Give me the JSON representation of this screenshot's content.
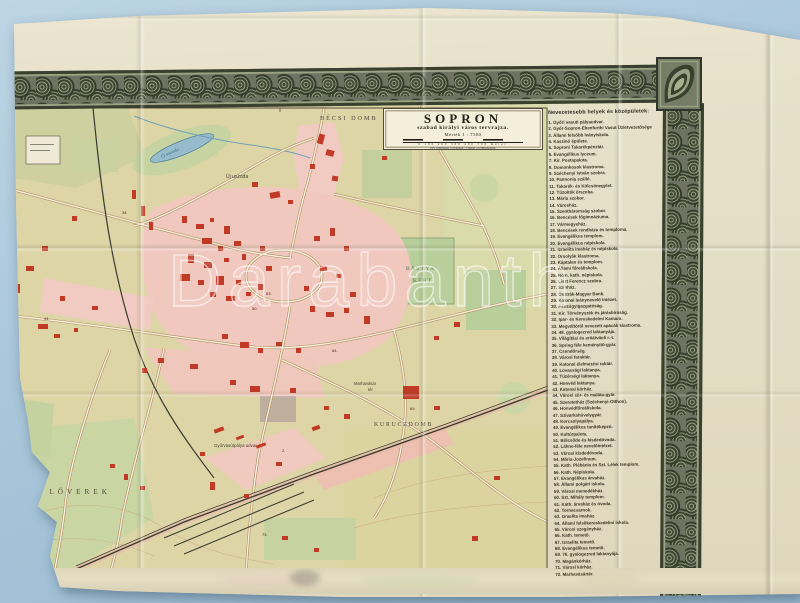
{
  "photo": {
    "background_color": "#a9c6da",
    "paper_color": "#e6e0c9",
    "ornament_color": "#4a5240"
  },
  "map_title": {
    "title": "SOPRON",
    "subtitle": "szabad királyi város tervrajza.",
    "scale": "Mérték 1 : 7500",
    "scale_ticks": "0 100 200 300 400 500",
    "scale_unit": "méter",
    "scale_note": "Egy centiméter a térképen 75 méter a természetben."
  },
  "legend": {
    "heading": "Nevezetesebb helyek és középületek:",
    "items": [
      "1. Győri vasuti pályaudvar.",
      "2. Győr-Sopron-Ebenfurthi Vasut Üzletvezetősége",
      "3. Állami felsőbb leányiskola.",
      "4. Kaszinó épülete.",
      "5. Soproni Takarékpénztár.",
      "6. Evangélikus lyceum.",
      "7. Kir. Postapalota.",
      "8. Domonkosok klastroma.",
      "9. Széchenyi István szobra.",
      "10. Pannonia szálló.",
      "11. Takarék- és Kölcsönegylet.",
      "12. Tűzoltók őrszoba.",
      "13. Mária szobor.",
      "14. Városház.",
      "15. Szentháromság szobor.",
      "16. Bencések főgimnáziuma.",
      "17. Vármegyeház.",
      "18. Bencések rendháza és temploma.",
      "19. Evangélikus templom.",
      "20. Evangélikus népiskola.",
      "21. Izraelita imaház és népiskola.",
      "22. Orsolyák klastroma.",
      "23. Káptalan és templom.",
      "24. Állami főreáliskola.",
      "25. Róm. kath. népiskola.",
      "26. Liszt Ferencz szobra.",
      "27. Színház.",
      "28. Osztrák-Magyar Bank.",
      "29. Katonai leánynevelő intézet.",
      "30. Pénzügyigazgatóság.",
      "31. Kir. Törvényszék és járásbíróság.",
      "32. Ipar- és Kereskedelmi Kamara.",
      "33. Megváltóról nevezett apácák klastroma.",
      "34. 48. gyalogezred laktanyája.",
      "35. Világítási és erőátviteli r.-t.",
      "36. Spring féle keményítő-gyár.",
      "37. Csendőrség.",
      "38. Városi faraktár.",
      "39. Katonai élelmezési raktár.",
      "40. Lovassági laktanya.",
      "41. Tüzérségi laktanya.",
      "42. Honvéd laktanya.",
      "43. Katonai kórház.",
      "44. Városi sör- és maláta-gyár.",
      "45. Szeretetház (Széchenyi-Otthon).",
      "46. Honvédfőreáliskola.",
      "47. Szivarkahüvelygyár.",
      "48. Korcsolyapálya.",
      "49. Evangélikus tanítóképző.",
      "50. Kultúrpalota.",
      "51. Bölcsőde és kisdedóvoda.",
      "52. Lähne-féle nevelőintézet.",
      "53. Városi kisdedóvoda.",
      "54. Mária-Jozefinum.",
      "55. Kath. Plébánia és Szt. Lélek templom.",
      "56. Kath. Népiskola.",
      "57. Evangélikus árvaház.",
      "58. Állami polgári iskola.",
      "59. Városi menedékház.",
      "60. Szt. Mihály templom.",
      "61. Kath. árvaház és óvoda.",
      "62. Tornacsarnok.",
      "63. Izraelita imaház.",
      "64. Állami felsőkereskedelmi iskola.",
      "65. Városi szegényház.",
      "66. Kath. temető.",
      "67. Izraelita temető.",
      "68. Evangélikus temető.",
      "69. 76. gyalogezred laktanyája.",
      "70. Magánkórház.",
      "71. Városi kórház.",
      "72. Marhavásártér."
    ]
  },
  "watermark": "Darabanth",
  "map_labels": [
    {
      "text": "BÉCSI DOMB",
      "x": 306,
      "y": 22,
      "size": 6.2,
      "ls": 2,
      "cls": "district-label"
    },
    {
      "text": "KIRÁLYHALOM",
      "x": 434,
      "y": 33,
      "size": 5.8,
      "ls": 1.5,
      "cls": "district-label"
    },
    {
      "text": "Ó uszoda",
      "x": 148,
      "y": 60,
      "size": 5,
      "rot": -24,
      "cls": "water-label"
    },
    {
      "text": "Új uszoda",
      "x": 212,
      "y": 80,
      "size": 5,
      "cls": "small-label"
    },
    {
      "text": "BÁSTYA",
      "x": 392,
      "y": 172,
      "size": 5.4,
      "ls": 1.4,
      "cls": "park-label"
    },
    {
      "text": "KERT",
      "x": 399,
      "y": 184,
      "size": 5.4,
      "ls": 1.4,
      "cls": "park-label"
    },
    {
      "text": "KURUCZDOMB",
      "x": 360,
      "y": 328,
      "size": 5.8,
      "ls": 1.8,
      "cls": "district-label"
    },
    {
      "text": "Marhavásár",
      "x": 340,
      "y": 287,
      "size": 4.2,
      "cls": "small-label"
    },
    {
      "text": "tér",
      "x": 354,
      "y": 293,
      "size": 4.2,
      "cls": "small-label"
    },
    {
      "text": "Győrvasútpálya udvar",
      "x": 200,
      "y": 349,
      "size": 4.4,
      "cls": "small-label"
    },
    {
      "text": "LSŐ  LŐVEREK",
      "x": 4,
      "y": 396,
      "size": 7.2,
      "ls": 4,
      "cls": "district-label"
    },
    {
      "text": "13°",
      "x": 260,
      "y": 7,
      "size": 5,
      "cls": "tick-label"
    }
  ],
  "map_numbers": [
    {
      "n": "34.",
      "x": 108,
      "y": 116
    },
    {
      "n": "44.",
      "x": 30,
      "y": 222
    },
    {
      "n": "50.",
      "x": 238,
      "y": 212
    },
    {
      "n": "63.",
      "x": 252,
      "y": 197
    },
    {
      "n": "64.",
      "x": 318,
      "y": 254
    },
    {
      "n": "69.",
      "x": 396,
      "y": 312
    },
    {
      "n": "2.",
      "x": 268,
      "y": 354
    },
    {
      "n": "73.",
      "x": 248,
      "y": 438
    }
  ],
  "buildings": [
    [
      304,
      36,
      6,
      10,
      15
    ],
    [
      312,
      52,
      8,
      6,
      15
    ],
    [
      296,
      66,
      5,
      5,
      0
    ],
    [
      318,
      78,
      6,
      5,
      10
    ],
    [
      368,
      58,
      5,
      4,
      0
    ],
    [
      238,
      84,
      6,
      5,
      0
    ],
    [
      256,
      94,
      10,
      6,
      -10
    ],
    [
      274,
      102,
      5,
      4,
      0
    ],
    [
      470,
      38,
      5,
      4,
      0
    ],
    [
      118,
      92,
      4,
      9,
      0
    ],
    [
      127,
      108,
      4,
      10,
      0
    ],
    [
      135,
      124,
      4,
      8,
      0
    ],
    [
      58,
      118,
      5,
      5,
      0
    ],
    [
      28,
      148,
      6,
      5,
      0
    ],
    [
      12,
      168,
      8,
      5,
      0
    ],
    [
      0,
      186,
      6,
      9,
      0
    ],
    [
      46,
      198,
      5,
      5,
      0
    ],
    [
      78,
      208,
      6,
      4,
      0
    ],
    [
      24,
      226,
      10,
      5,
      0
    ],
    [
      40,
      236,
      6,
      4,
      0
    ],
    [
      60,
      230,
      4,
      4,
      0
    ],
    [
      168,
      118,
      5,
      7,
      0
    ],
    [
      182,
      126,
      8,
      5,
      0
    ],
    [
      196,
      120,
      4,
      4,
      0
    ],
    [
      210,
      128,
      6,
      8,
      0
    ],
    [
      188,
      140,
      10,
      6,
      0
    ],
    [
      204,
      148,
      5,
      5,
      0
    ],
    [
      220,
      143,
      7,
      5,
      0
    ],
    [
      174,
      156,
      6,
      9,
      0
    ],
    [
      190,
      164,
      8,
      6,
      0
    ],
    [
      210,
      160,
      5,
      4,
      0
    ],
    [
      228,
      156,
      4,
      6,
      0
    ],
    [
      166,
      176,
      10,
      7,
      0
    ],
    [
      184,
      182,
      6,
      5,
      0
    ],
    [
      202,
      178,
      8,
      9,
      0
    ],
    [
      222,
      182,
      5,
      5,
      0
    ],
    [
      196,
      194,
      6,
      5,
      0
    ],
    [
      212,
      198,
      9,
      5,
      0
    ],
    [
      232,
      194,
      5,
      4,
      0
    ],
    [
      246,
      148,
      5,
      5,
      0
    ],
    [
      252,
      168,
      6,
      5,
      0
    ],
    [
      244,
      186,
      5,
      6,
      0
    ],
    [
      300,
      138,
      6,
      5,
      0
    ],
    [
      316,
      130,
      5,
      8,
      0
    ],
    [
      330,
      148,
      5,
      5,
      0
    ],
    [
      306,
      168,
      7,
      5,
      0
    ],
    [
      322,
      176,
      5,
      4,
      0
    ],
    [
      290,
      188,
      5,
      5,
      0
    ],
    [
      336,
      194,
      6,
      5,
      0
    ],
    [
      296,
      208,
      5,
      6,
      0
    ],
    [
      312,
      214,
      8,
      5,
      0
    ],
    [
      330,
      210,
      5,
      5,
      0
    ],
    [
      350,
      218,
      6,
      8,
      0
    ],
    [
      208,
      236,
      6,
      5,
      0
    ],
    [
      226,
      244,
      9,
      6,
      0
    ],
    [
      244,
      250,
      5,
      5,
      0
    ],
    [
      262,
      244,
      6,
      4,
      0
    ],
    [
      282,
      250,
      5,
      5,
      0
    ],
    [
      144,
      260,
      6,
      5,
      0
    ],
    [
      128,
      270,
      5,
      5,
      0
    ],
    [
      176,
      266,
      8,
      5,
      0
    ],
    [
      216,
      282,
      6,
      5,
      0
    ],
    [
      236,
      288,
      10,
      6,
      0
    ],
    [
      276,
      290,
      6,
      5,
      0
    ],
    [
      310,
      308,
      5,
      4,
      0
    ],
    [
      330,
      316,
      6,
      5,
      0
    ],
    [
      389,
      288,
      16,
      13,
      0
    ],
    [
      420,
      308,
      6,
      4,
      0
    ],
    [
      298,
      328,
      8,
      4,
      -20
    ],
    [
      200,
      330,
      10,
      4,
      -20
    ],
    [
      222,
      338,
      8,
      3,
      -20
    ],
    [
      242,
      346,
      10,
      3,
      -20
    ],
    [
      186,
      354,
      5,
      4,
      0
    ],
    [
      262,
      364,
      6,
      4,
      0
    ],
    [
      196,
      384,
      5,
      8,
      0
    ],
    [
      230,
      396,
      5,
      4,
      0
    ],
    [
      96,
      366,
      5,
      4,
      0
    ],
    [
      110,
      376,
      4,
      6,
      0
    ],
    [
      126,
      388,
      5,
      4,
      0
    ],
    [
      268,
      438,
      6,
      4,
      0
    ],
    [
      300,
      450,
      5,
      4,
      0
    ],
    [
      480,
      378,
      6,
      4,
      0
    ],
    [
      458,
      438,
      6,
      5,
      0
    ],
    [
      420,
      238,
      5,
      4,
      0
    ],
    [
      440,
      224,
      6,
      5,
      0
    ]
  ],
  "colors": {
    "urban_pink": "#f1cbc1",
    "park_green": "#c2d39e",
    "building_red": "#c13a26",
    "water_blue": "#97bccc",
    "map_base": "#ddd5a6",
    "rail_dark": "#3b3a30"
  }
}
